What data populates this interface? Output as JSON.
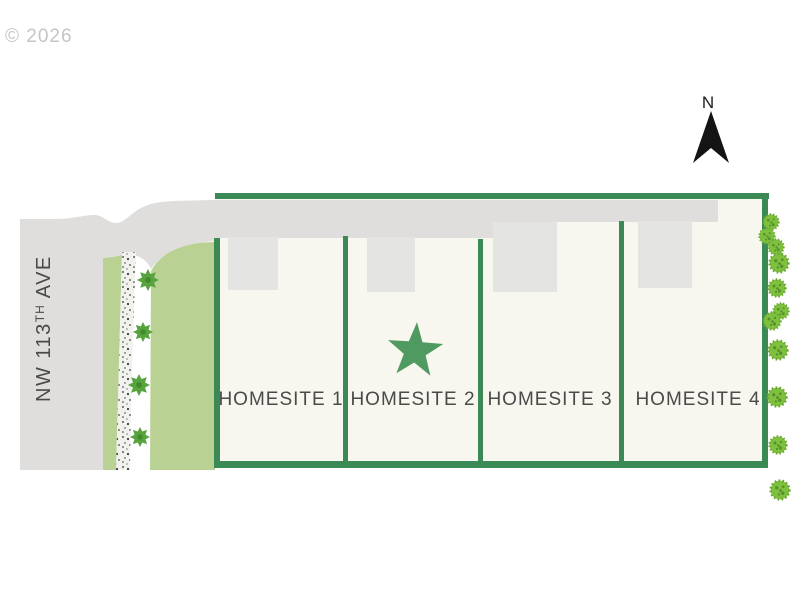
{
  "watermark": {
    "copyright": "© 2026"
  },
  "compass": {
    "north_label": "N"
  },
  "street_label": {
    "prefix": "NW 113",
    "superscript": "TH",
    "suffix": " AVE"
  },
  "homesites": [
    {
      "label": "HOMESITE 1",
      "has_star_marker": false
    },
    {
      "label": "HOMESITE 2",
      "has_star_marker": true
    },
    {
      "label": "HOMESITE 3",
      "has_star_marker": false
    },
    {
      "label": "HOMESITE 4",
      "has_star_marker": false
    }
  ],
  "colors": {
    "property_border_green": "#3b8a56",
    "star_green": "#4e9a60",
    "landscape_light_green": "#b9d293",
    "road_gray": "#dfdedd",
    "driveway_gray": "#e4e4e2",
    "lot_cream": "#f7f6ef",
    "path_white": "#f1f1ee",
    "tree_green": "#57a33d",
    "bush_green": "#7fc13f",
    "bush_dot_green": "#55922a",
    "label_text": "#4a4a4a",
    "watermark_gray": "#c5c5c5",
    "north_arrow_black": "#141414"
  }
}
